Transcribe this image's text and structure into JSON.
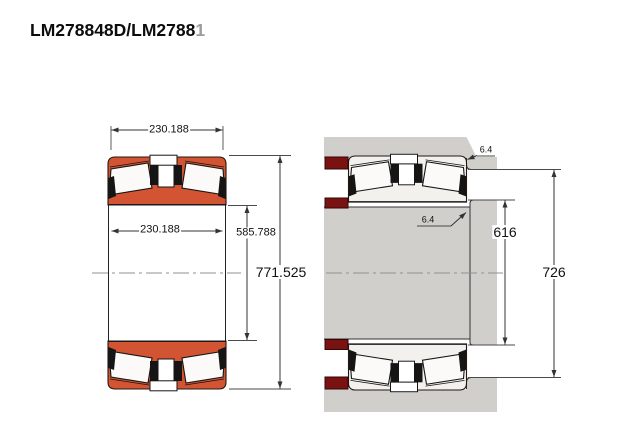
{
  "title": {
    "text": "LM278848D/LM2788",
    "clipped": "1"
  },
  "left_figure": {
    "dim_width_top": "230.188",
    "dim_width_inner": "230.188",
    "dim_bore_diameter": "585.788",
    "dim_outer_diameter": "771.525",
    "ring_color": "#d25432"
  },
  "right_figure": {
    "dim_fillet_housing": "6.4",
    "dim_fillet_shaft": "6.4",
    "dim_shaft_shoulder_diameter": "616",
    "dim_housing_shoulder_diameter": "726",
    "housing_color": "#d0cfcc",
    "spacer_color": "#7a1212",
    "bearing_fill": "#f2f1ee"
  }
}
